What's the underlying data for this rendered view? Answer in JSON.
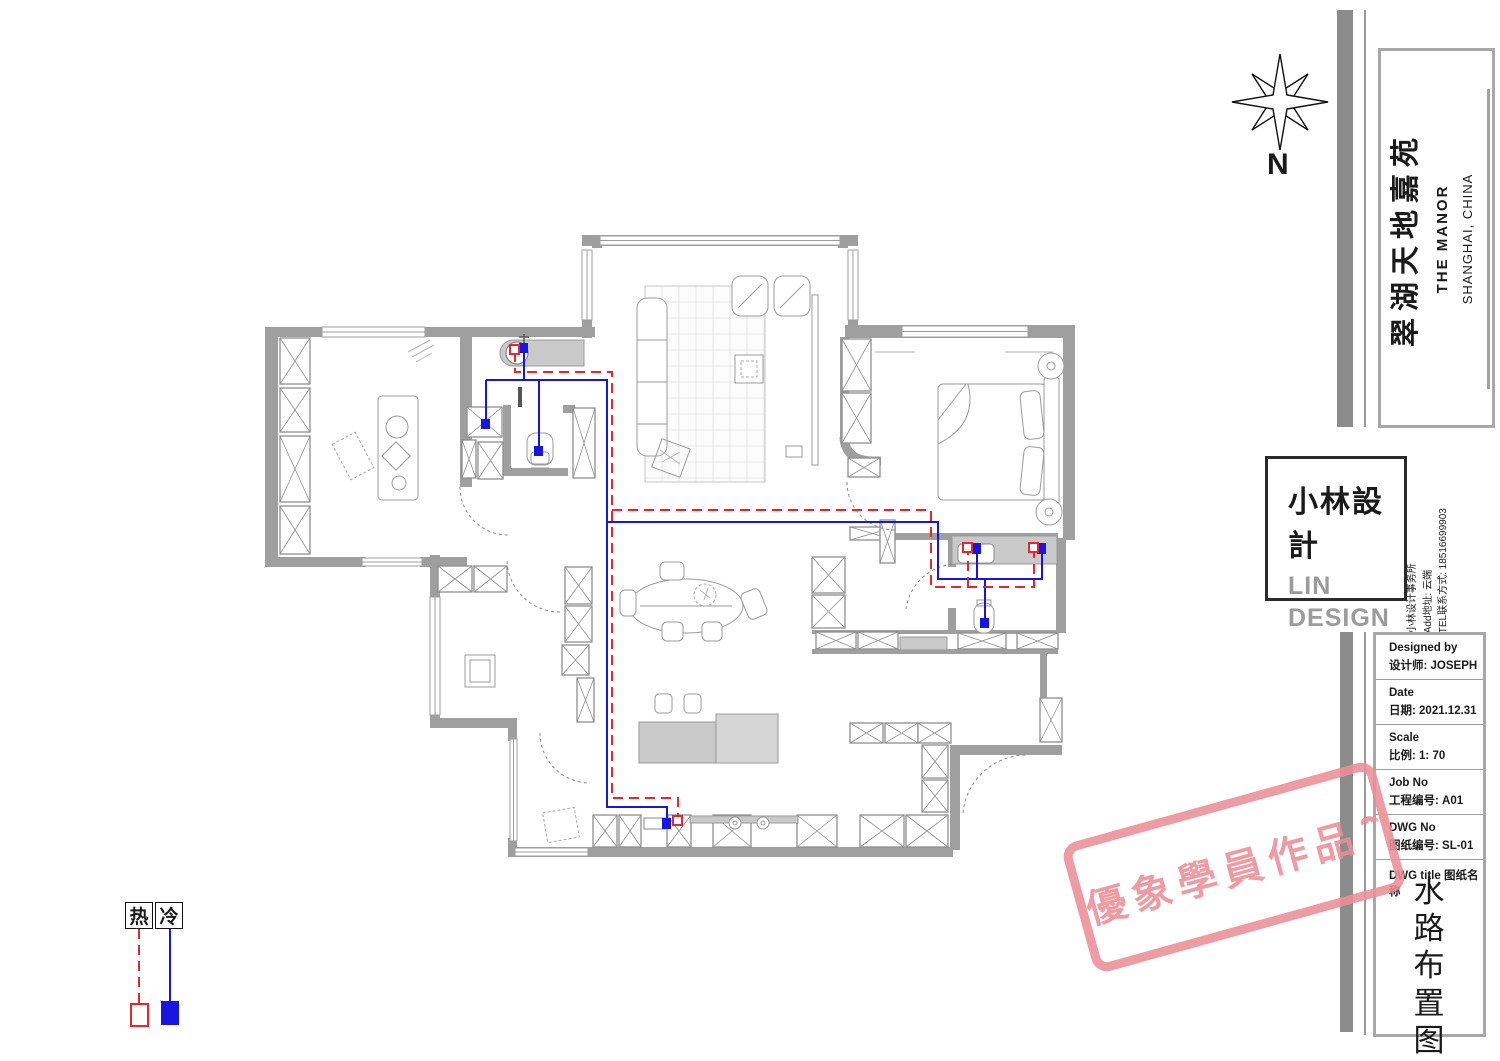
{
  "compass": {
    "label": "N"
  },
  "legend": {
    "hot_label": "热",
    "cold_label": "冷"
  },
  "title_block": {
    "project": {
      "name_cn": "翠湖天地嘉苑",
      "name_en": "THE MANOR",
      "location": "SHANGHAI, CHINA"
    },
    "logo": {
      "name_cn": "小林設計",
      "line1": "LIN",
      "line2": "DESIGN"
    },
    "firm": {
      "line1": "小林设计事务所",
      "line2": "Add地址: 云端",
      "line3": "TEL联系方式: 18516699903"
    },
    "fields": [
      {
        "label_en": "Designed by",
        "value": "设计师: JOSEPH"
      },
      {
        "label_en": "Date",
        "value": "日期: 2021.12.31"
      },
      {
        "label_en": "Scale",
        "value": "比例: 1:  70"
      },
      {
        "label_en": "Job No",
        "value": "工程编号: A01"
      },
      {
        "label_en": "DWG No",
        "value": "图纸编号: SL-01"
      }
    ],
    "dwg_title_label": "DWG title 图纸名称",
    "dwg_title": "水路布置图"
  },
  "stamp": {
    "text": "優象學員作品"
  },
  "colors": {
    "hot": "#e8262b",
    "cold": "#1616e0",
    "wall": "#9f9f9f",
    "stamp": "#ec8f98"
  }
}
